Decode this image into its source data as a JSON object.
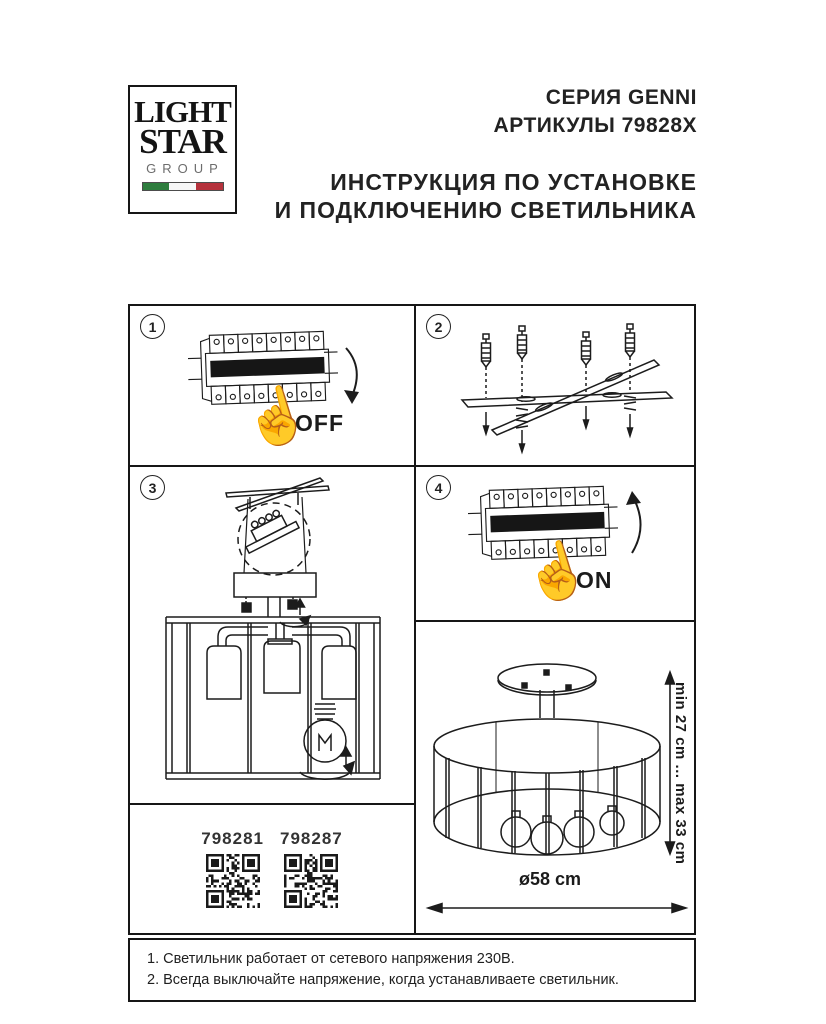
{
  "header": {
    "logo": {
      "word1": "LIGHT",
      "word2": "STAR",
      "word3": "GROUP"
    },
    "series": "СЕРИЯ GENNI",
    "articles": "АРТИКУЛЫ 79828X",
    "title_line1": "ИНСТРУКЦИЯ ПО УСТАНОВКЕ",
    "title_line2": "И ПОДКЛЮЧЕНИЮ СВЕТИЛЬНИКА"
  },
  "steps": {
    "s1": {
      "num": "1",
      "label": "OFF"
    },
    "s2": {
      "num": "2"
    },
    "s3": {
      "num": "3"
    },
    "s4": {
      "num": "4",
      "label": "ON"
    }
  },
  "qr": {
    "left": "798281",
    "right": "798287"
  },
  "dims": {
    "height": "min 27 cm ... max 33 cm",
    "diameter": "ø58 cm"
  },
  "notes": {
    "n1": "1. Светильник работает от сетевого напряжения 230В.",
    "n2": "2. Всегда выключайте напряжение, когда устанавливаете светильник."
  },
  "colors": {
    "ink": "#1c1c1c",
    "flag_green": "#2e7d3e",
    "flag_white": "#f7f7f7",
    "flag_red": "#b5323c"
  }
}
